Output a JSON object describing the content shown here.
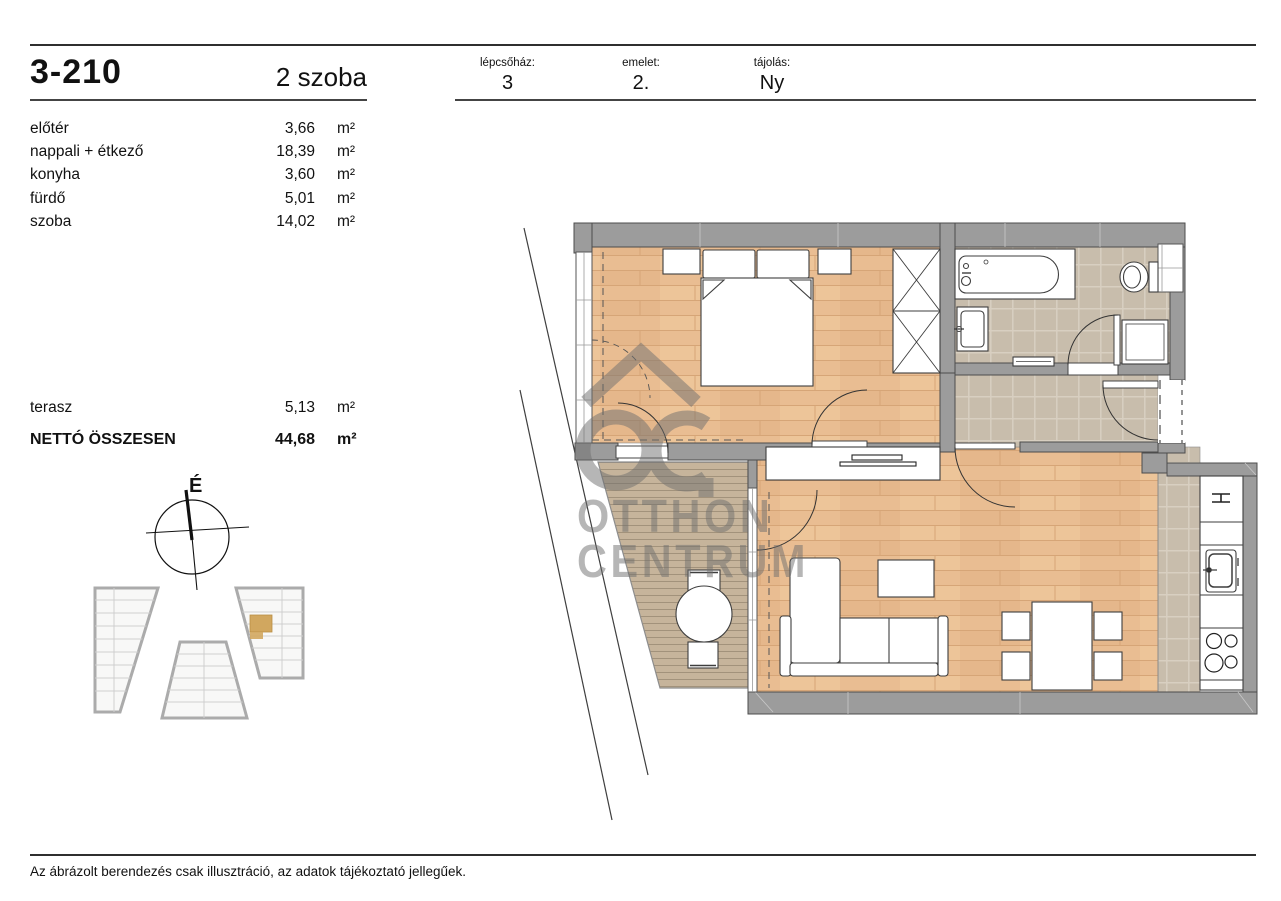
{
  "header": {
    "unit_id": "3-210",
    "room_count": "2 szoba",
    "fields": [
      {
        "label": "lépcsőház:",
        "value": "3"
      },
      {
        "label": "emelet:",
        "value": "2."
      },
      {
        "label": "tájolás:",
        "value": "Ny"
      }
    ]
  },
  "rooms": [
    {
      "name": "előtér",
      "area": "3,66",
      "unit": "m²"
    },
    {
      "name": "nappali + étkező",
      "area": "18,39",
      "unit": "m²"
    },
    {
      "name": "konyha",
      "area": "3,60",
      "unit": "m²"
    },
    {
      "name": "fürdő",
      "area": "5,01",
      "unit": "m²"
    },
    {
      "name": "szoba",
      "area": "14,02",
      "unit": "m²"
    }
  ],
  "outdoor": {
    "name": "terasz",
    "area": "5,13",
    "unit": "m²"
  },
  "total": {
    "label": "NETTÓ ÖSSZESEN",
    "area": "44,68",
    "unit": "m²"
  },
  "compass": {
    "north_label": "É"
  },
  "watermark": {
    "line1": "OTTHON",
    "line2": "CENTRUM"
  },
  "footer": {
    "disclaimer": "Az ábrázolt berendezés csak illusztráció, az adatok tájékoztató jellegűek."
  },
  "colors": {
    "wood_floor": "#e9bd92",
    "tile_floor": "#c8bdac",
    "deck_floor": "#c6b49b",
    "wall": "#9c9c9c",
    "site_highlight": "#d1a75f",
    "watermark_gray": "#6f6f6f"
  }
}
